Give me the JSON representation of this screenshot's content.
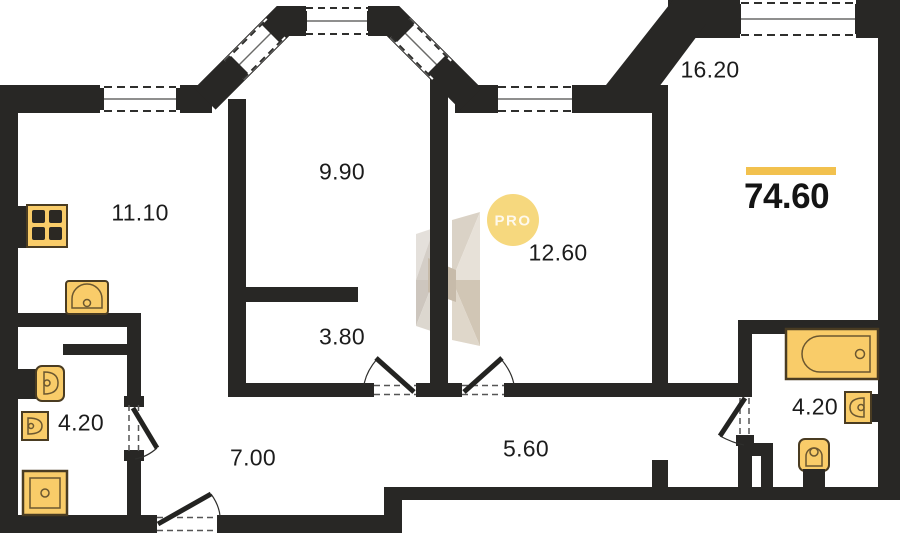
{
  "floorplan": {
    "total": {
      "area_label": "74.60"
    },
    "watermark": {
      "badge": "PRO"
    },
    "rooms": [
      {
        "key": "kitchen",
        "area": "11.10"
      },
      {
        "key": "room-top",
        "area": "9.90"
      },
      {
        "key": "room-middle",
        "area": "12.60"
      },
      {
        "key": "room-right",
        "area": "16.20"
      },
      {
        "key": "storage",
        "area": "3.80"
      },
      {
        "key": "bathroom-left",
        "area": "4.20"
      },
      {
        "key": "hallway",
        "area": "7.00"
      },
      {
        "key": "hall-inner",
        "area": "5.60"
      },
      {
        "key": "bathroom-right",
        "area": "4.20"
      }
    ],
    "colors": {
      "wall": "#282725",
      "accent": "#F2C14E",
      "fixture_fill": "#F9CC69",
      "badge_fill": "#F6D87E"
    }
  }
}
